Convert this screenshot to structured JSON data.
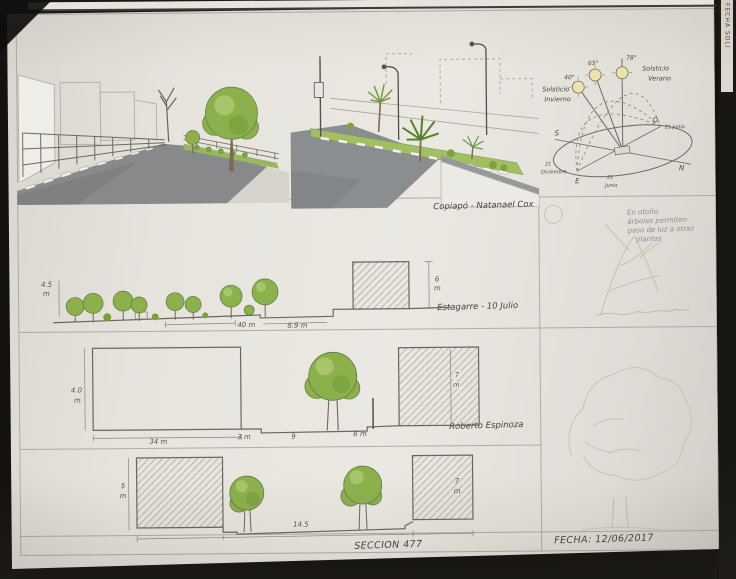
{
  "edge": {
    "vertical_text": "FECHA SOLI"
  },
  "annotations": {
    "copiapo": "Copiapó - Natanael Cox",
    "estagarre": "Estagarre - 10 Julio",
    "roberto": "Roberto Espinoza",
    "seccion": "SECCION 477",
    "fecha": "FECHA: 12/06/2017",
    "autumn_note": [
      "En otoño",
      "árboles permiten",
      "paso de luz a otras",
      "plantas"
    ]
  },
  "sun": {
    "solsticio_invierno": [
      "Solsticio",
      "Invierno"
    ],
    "solsticio_verano": [
      "Solsticio",
      "Verano"
    ],
    "angles": [
      "40°",
      "65°",
      "78°"
    ],
    "cardinals": {
      "s": "S",
      "e": "E",
      "n": "N",
      "o": "O"
    },
    "dates": {
      "west": "21 Junio",
      "east": [
        "21",
        "Junio"
      ],
      "south": [
        "21",
        "Diciembre"
      ]
    }
  },
  "sections": {
    "s1": {
      "height_left": [
        "4.5",
        "m"
      ],
      "trees_width": "40 m",
      "road_width": "8.9 m",
      "height_right": [
        "6",
        "m"
      ]
    },
    "s2": {
      "height_left": [
        "4.0",
        "m"
      ],
      "block_width": "34 m",
      "gap": "3 m",
      "median_width": "9",
      "walk_width": "8 m",
      "height_right": [
        "7",
        "m"
      ]
    },
    "s3": {
      "height_left": [
        "5",
        "m"
      ],
      "road_width": "14.5",
      "height_right": [
        "7",
        "m"
      ]
    }
  }
}
